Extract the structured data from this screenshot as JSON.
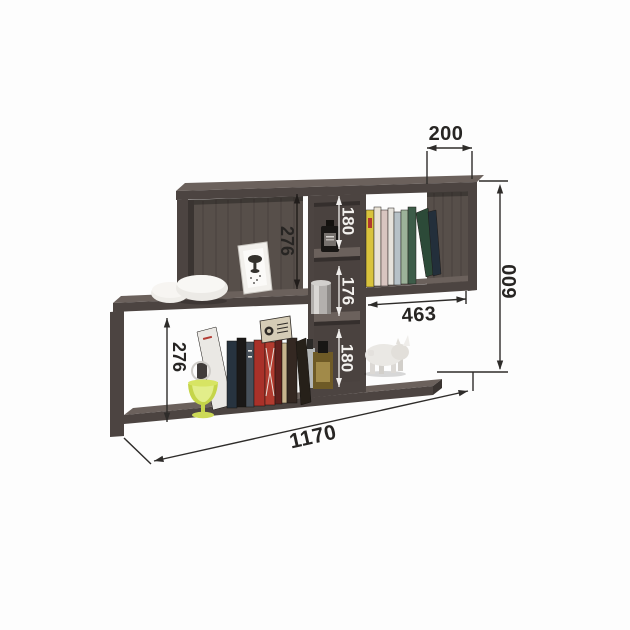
{
  "diagram": {
    "background": "#fdfdfd",
    "labels": {
      "top_section_width": "200",
      "overall_height": "600",
      "overall_width": "1170",
      "right_shelf_width": "463",
      "upper_compartment_height": "276",
      "lower_compartment_height": "276",
      "middle_cell_top": "180",
      "middle_cell_center": "176",
      "middle_cell_bottom": "180"
    },
    "colors": {
      "wood_front": "#4c4441",
      "wood_top": "#6b615c",
      "wood_back": "#574f4a",
      "wood_dark": "#3a3431",
      "dim_line_dark": "#2e2c2a",
      "dim_line_light": "#f0eeec",
      "label_dark": "#272523",
      "label_light": "#f3f1ee"
    }
  }
}
